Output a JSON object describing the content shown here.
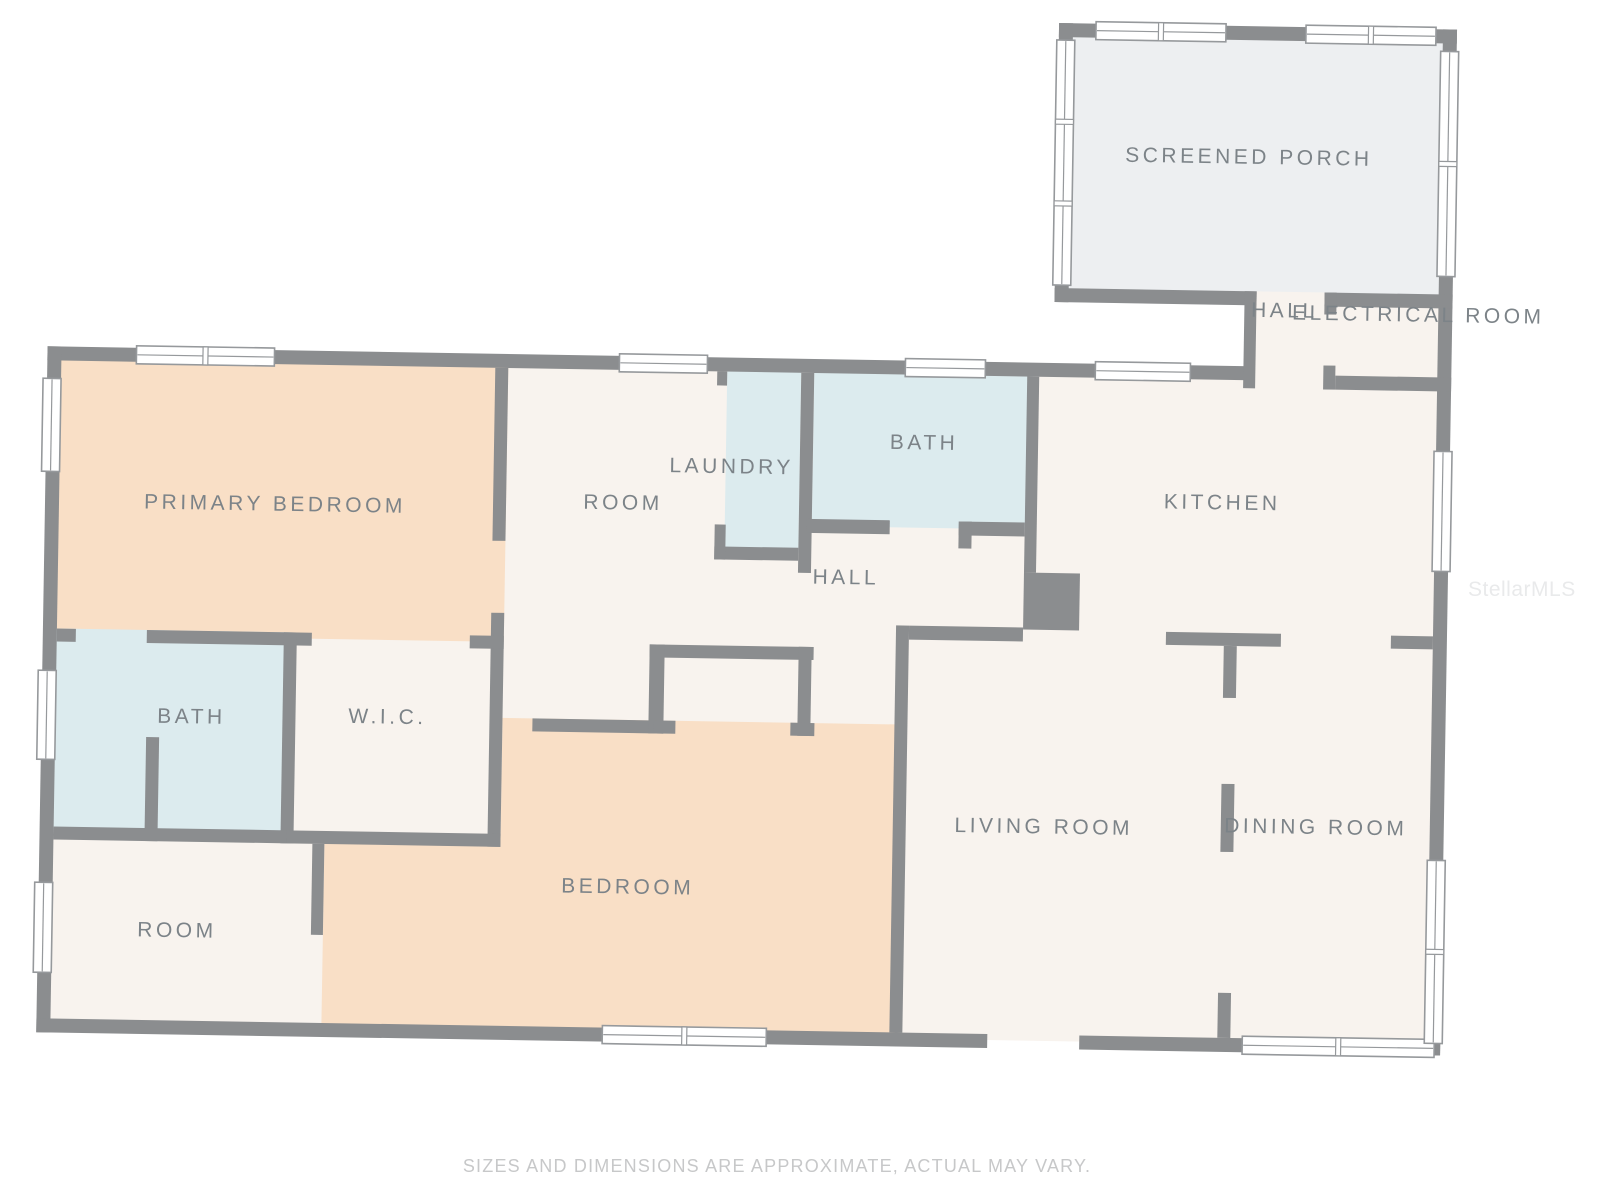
{
  "palette": {
    "wall": "#8b8d8f",
    "window_frame": "#96999c",
    "window_fill": "#ffffff",
    "cream": "#f8f3ee",
    "peach": "#f9dfc6",
    "blue": "#dcebee",
    "porch": "#edeff1",
    "label": "#7c8388",
    "footer": "#c7c8c9",
    "watermark": "#e9eaeb",
    "background": "#ffffff"
  },
  "rooms": [
    {
      "id": "screened-porch",
      "label": "SCREENED PORCH",
      "x": 1240,
      "y": 150,
      "fill": "porch"
    },
    {
      "id": "hall-top",
      "label": "HALL",
      "x": 1278,
      "y": 303,
      "fill": "cream"
    },
    {
      "id": "electrical-room",
      "label": "ELECTRICAL ROOM",
      "x": 1412,
      "y": 305,
      "fill": "cream"
    },
    {
      "id": "primary-bedroom",
      "label": "PRIMARY BEDROOM",
      "x": 272,
      "y": 513,
      "fill": "peach"
    },
    {
      "id": "room-upper",
      "label": "ROOM",
      "x": 620,
      "y": 506,
      "fill": "cream"
    },
    {
      "id": "laundry",
      "label": "LAUNDRY",
      "x": 728,
      "y": 468,
      "fill": "blue"
    },
    {
      "id": "bath-upper",
      "label": "BATH",
      "x": 920,
      "y": 441,
      "fill": "blue"
    },
    {
      "id": "kitchen",
      "label": "KITCHEN",
      "x": 1219,
      "y": 496,
      "fill": "cream"
    },
    {
      "id": "hall-middle",
      "label": "HALL",
      "x": 844,
      "y": 577,
      "fill": "cream"
    },
    {
      "id": "bath-left",
      "label": "BATH",
      "x": 192,
      "y": 727,
      "fill": "blue"
    },
    {
      "id": "wic",
      "label": "W.I.C.",
      "x": 388,
      "y": 724,
      "fill": "cream"
    },
    {
      "id": "room-lower",
      "label": "ROOM",
      "x": 181,
      "y": 941,
      "fill": "cream"
    },
    {
      "id": "bedroom",
      "label": "BEDROOM",
      "x": 631,
      "y": 890,
      "fill": "peach"
    },
    {
      "id": "living-room",
      "label": "LIVING ROOM",
      "x": 1046,
      "y": 823,
      "fill": "cream"
    },
    {
      "id": "dining-room",
      "label": "DINING ROOM",
      "x": 1318,
      "y": 819,
      "fill": "cream"
    }
  ],
  "footer": {
    "disclaimer": "SIZES AND DIMENSIONS ARE APPROXIMATE, ACTUAL MAY VARY."
  },
  "watermark": "StellarMLS"
}
